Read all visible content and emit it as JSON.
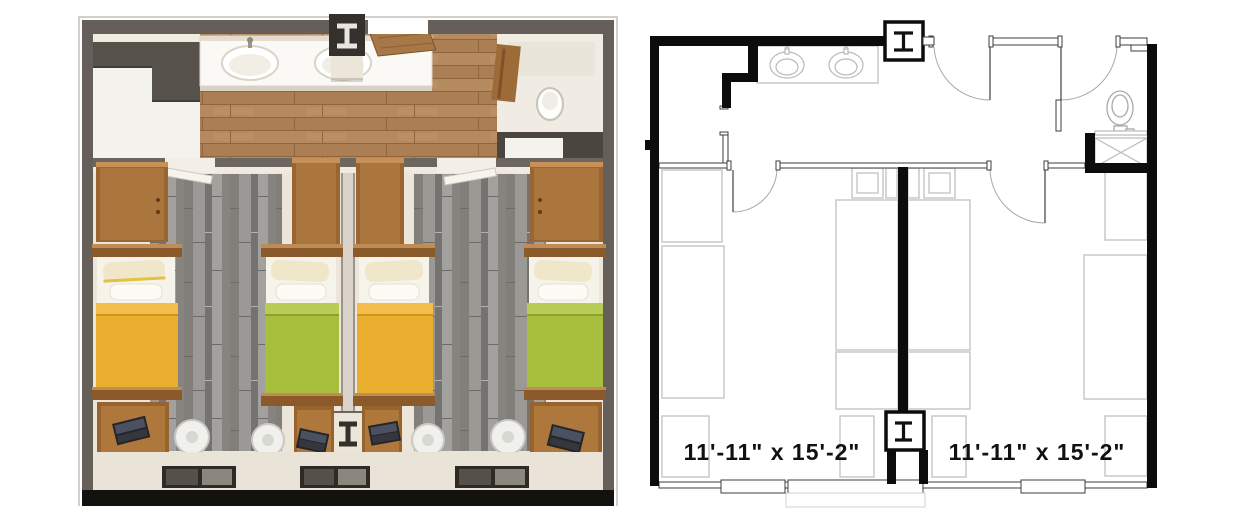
{
  "unit": {
    "type": "double-occupancy dorm suite",
    "views": [
      {
        "name": "render-3d-top-view"
      },
      {
        "name": "floor-plan-2d"
      }
    ]
  },
  "floor_plan": {
    "rooms": [
      {
        "name": "bedroom-left",
        "dimensions": "11'-11\" x  15'-2\""
      },
      {
        "name": "bedroom-right",
        "dimensions": "11'-11\" x  15'-2\""
      }
    ],
    "fixtures": [
      "double-sink-vanity",
      "toilet",
      "shower",
      "steel-column-top",
      "steel-column-bottom"
    ],
    "furniture": [
      "wardrobe",
      "bed",
      "dresser",
      "desk",
      "window"
    ]
  },
  "palette": {
    "plan_wall_black": "#0c0c0c",
    "plan_line_gray": "#bdbdbd",
    "render_wall_gray": "#665f59",
    "wood_floor": "#b28759",
    "carpet_gray": "#8f8d89",
    "bed_yellow": "#eaae2f",
    "bed_yellow_fold": "#f4bd49",
    "bed_green": "#a8bf3e",
    "bed_green_fold": "#b9cc55",
    "furniture_wood": "#9c6731",
    "cream_floor": "#ece6da",
    "black_base_bar": "#14120f"
  }
}
